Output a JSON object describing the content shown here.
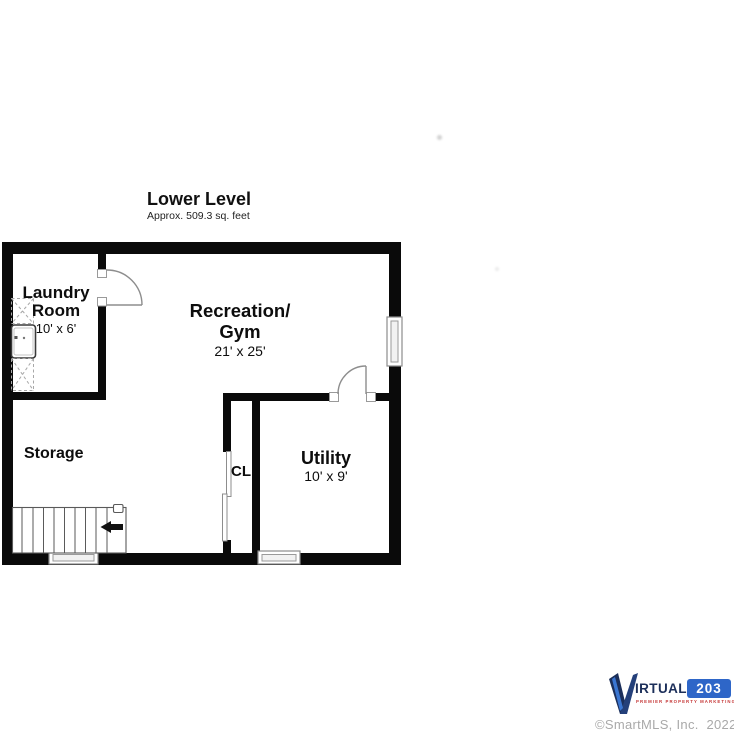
{
  "page": {
    "background": "#ffffff",
    "width": 734,
    "height": 736
  },
  "plan": {
    "title": "Lower Level",
    "subtitle": "Approx. 509.3 sq. feet",
    "wall_color": "#0a0a0a",
    "rooms": {
      "laundry": {
        "name_line1": "Laundry",
        "name_line2": "Room",
        "dimensions": "10' x 6'"
      },
      "recreation": {
        "name_line1": "Recreation/",
        "name_line2": "Gym",
        "dimensions": "21' x 25'"
      },
      "storage": {
        "name": "Storage"
      },
      "closet": {
        "name": "CL"
      },
      "utility": {
        "name": "Utility",
        "dimensions": "10' x 9'"
      }
    },
    "symbols": [
      "stairs",
      "stair-direction-arrow",
      "door-swing-arc",
      "window",
      "sliding-closet-door",
      "washer",
      "hatched-counter"
    ]
  },
  "branding": {
    "logo_name": "IRTUAL",
    "logo_number": "203",
    "tagline": "PREMIER PROPERTY MARKETING",
    "colors": {
      "navy": "#1c2f5a",
      "blue": "#2e66c8",
      "red": "#c53737"
    }
  },
  "footer": {
    "copyright": "©SmartMLS, Inc.  2022"
  }
}
